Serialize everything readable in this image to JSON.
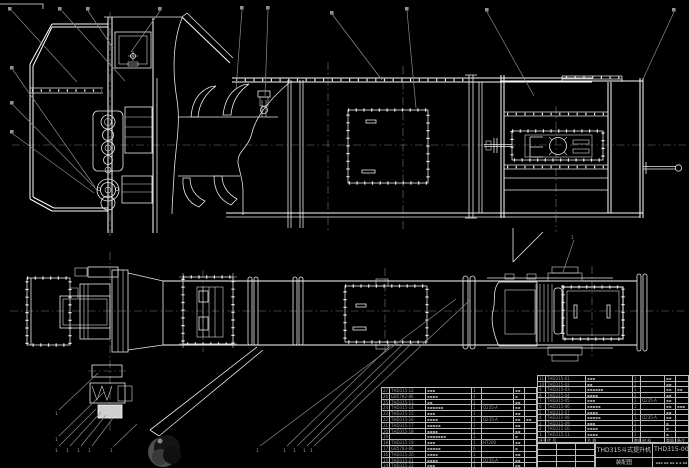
{
  "colors": {
    "background": "#000000",
    "line": "#e9e9e9",
    "leader": "#8c8c8c",
    "table_grid": "#bdbdbd",
    "table_text": "#9a9a9a"
  },
  "balloon_label": "1",
  "title_block": {
    "product": "THD315斗式提升机",
    "doc_type": "装配图",
    "drawing_no": "THD315-00",
    "info_row": "▪▪▪ ▪▪ ▪▪ ▪ ▪ ▪▪"
  },
  "bom_right": {
    "header_rows": [
      [
        "序号",
        "代 号",
        "名 称",
        "数量",
        "材 料",
        "重量",
        "备注"
      ]
    ],
    "rows": [
      [
        "11",
        "THD315-01",
        "▪▪▪",
        "1",
        "",
        "▪▪",
        ""
      ],
      [
        "10",
        "THD315-02",
        "▪▪",
        "1",
        "",
        "▪▪",
        ""
      ],
      [
        "9",
        "THD315-03",
        "▪▪▪▪▪▪",
        "1",
        "",
        "▪▪",
        "▪▪"
      ],
      [
        "8",
        "THD315-04",
        "▪▪▪▪",
        "2",
        "",
        "▪▪",
        ""
      ],
      [
        "7",
        "THD315-05",
        "▪▪▪",
        "1",
        "Q235-A",
        "▪▪",
        ""
      ],
      [
        "6",
        "THD315-06",
        "▪▪▪▪▪",
        "1",
        "",
        "▪▪",
        "▪▪▪"
      ],
      [
        "5",
        "THD315-07",
        "▪▪▪▪",
        "1",
        "",
        "▪▪",
        ""
      ],
      [
        "4",
        "THD315-08",
        "▪▪▪▪▪",
        "1",
        "Q235-A",
        "▪▪",
        ""
      ],
      [
        "3",
        "THD315-09",
        "▪▪▪",
        "1",
        "",
        "▪",
        ""
      ],
      [
        "2",
        "THD315-10",
        "▪▪▪▪",
        "1",
        "",
        "▪",
        ""
      ],
      [
        "1",
        "THD315-11",
        "▪▪▪▪",
        "1",
        "",
        "▪",
        ""
      ]
    ]
  },
  "bom_left": {
    "rows": [
      [
        "27",
        "THD315-12",
        "▪▪▪",
        "1",
        "",
        "▪▪",
        ""
      ],
      [
        "26",
        "GB5782-86",
        "▪▪▪▪",
        "4",
        "",
        "▪",
        ""
      ],
      [
        "25",
        "THD315-13",
        "▪▪",
        "1",
        "",
        "▪▪",
        ""
      ],
      [
        "24",
        "THD315-14",
        "▪▪▪▪▪▪",
        "1",
        "Q235-A",
        "▪▪",
        ""
      ],
      [
        "23",
        "THD315-15",
        "▪▪▪",
        "1",
        "",
        "▪▪",
        ""
      ],
      [
        "22",
        "THD315-16",
        "▪▪▪▪",
        "1",
        "Q235-A",
        "▪▪",
        "▪▪"
      ],
      [
        "21",
        "THD315-17",
        "▪▪▪▪▪",
        "1",
        "",
        "▪▪",
        ""
      ],
      [
        "20",
        "THD315-18",
        "▪▪▪▪",
        "1",
        "",
        "▪▪",
        ""
      ],
      [
        "19",
        "",
        "▪▪▪▪▪▪▪",
        "1",
        "",
        "▪",
        ""
      ],
      [
        "18",
        "THD315-19",
        "▪▪▪",
        "1",
        "HT200",
        "▪▪",
        ""
      ],
      [
        "17",
        "GB5783-86",
        "▪▪▪▪▪",
        "6",
        "",
        "▪",
        ""
      ],
      [
        "16",
        "THD315-20",
        "▪▪▪▪",
        "1",
        "",
        "▪▪",
        ""
      ],
      [
        "15",
        "THD315-21",
        "▪▪▪▪",
        "1",
        "Q235-A",
        "▪▪",
        ""
      ],
      [
        "14",
        "THD315-22",
        "▪▪▪",
        "1",
        "",
        "▪▪",
        ""
      ]
    ]
  }
}
